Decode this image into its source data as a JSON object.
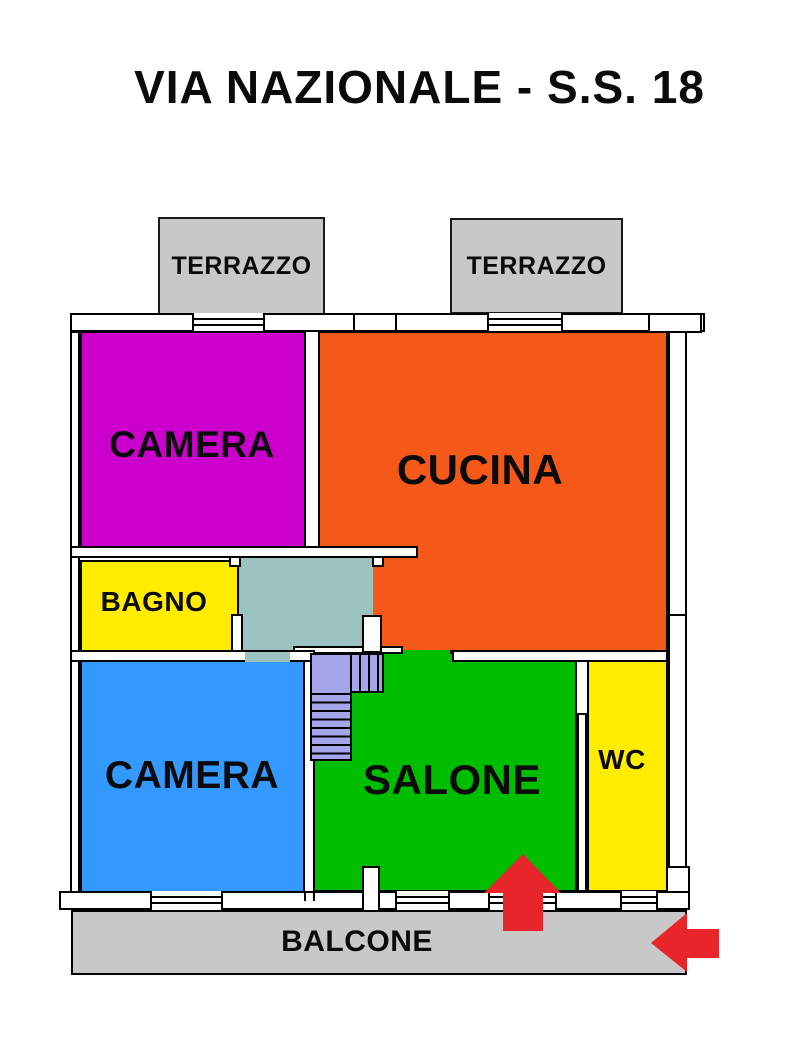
{
  "title": "VIA NAZIONALE - S.S. 18",
  "floorplan": {
    "terraces": [
      {
        "label": "TERRAZZO",
        "color": "#C8C8C8"
      },
      {
        "label": "TERRAZZO",
        "color": "#C8C8C8"
      }
    ],
    "rooms": {
      "camera_top": {
        "label": "CAMERA",
        "color": "#CC00CC"
      },
      "cucina": {
        "label": "CUCINA",
        "color": "#F5591A"
      },
      "bagno": {
        "label": "BAGNO",
        "color": "#FFEC00"
      },
      "corridoio": {
        "label": "",
        "color": "#9CC2C0"
      },
      "scala": {
        "label": "",
        "color": "#A5A5EC"
      },
      "camera_bottom": {
        "label": "CAMERA",
        "color": "#3399FF"
      },
      "salone": {
        "label": "SALONE",
        "color": "#00BD00"
      },
      "wc": {
        "label": "WC",
        "color": "#FFEC00"
      },
      "balcone": {
        "label": "BALCONE",
        "color": "#C8C8C8"
      }
    },
    "entrance_arrows": {
      "color": "#E8252B"
    }
  }
}
